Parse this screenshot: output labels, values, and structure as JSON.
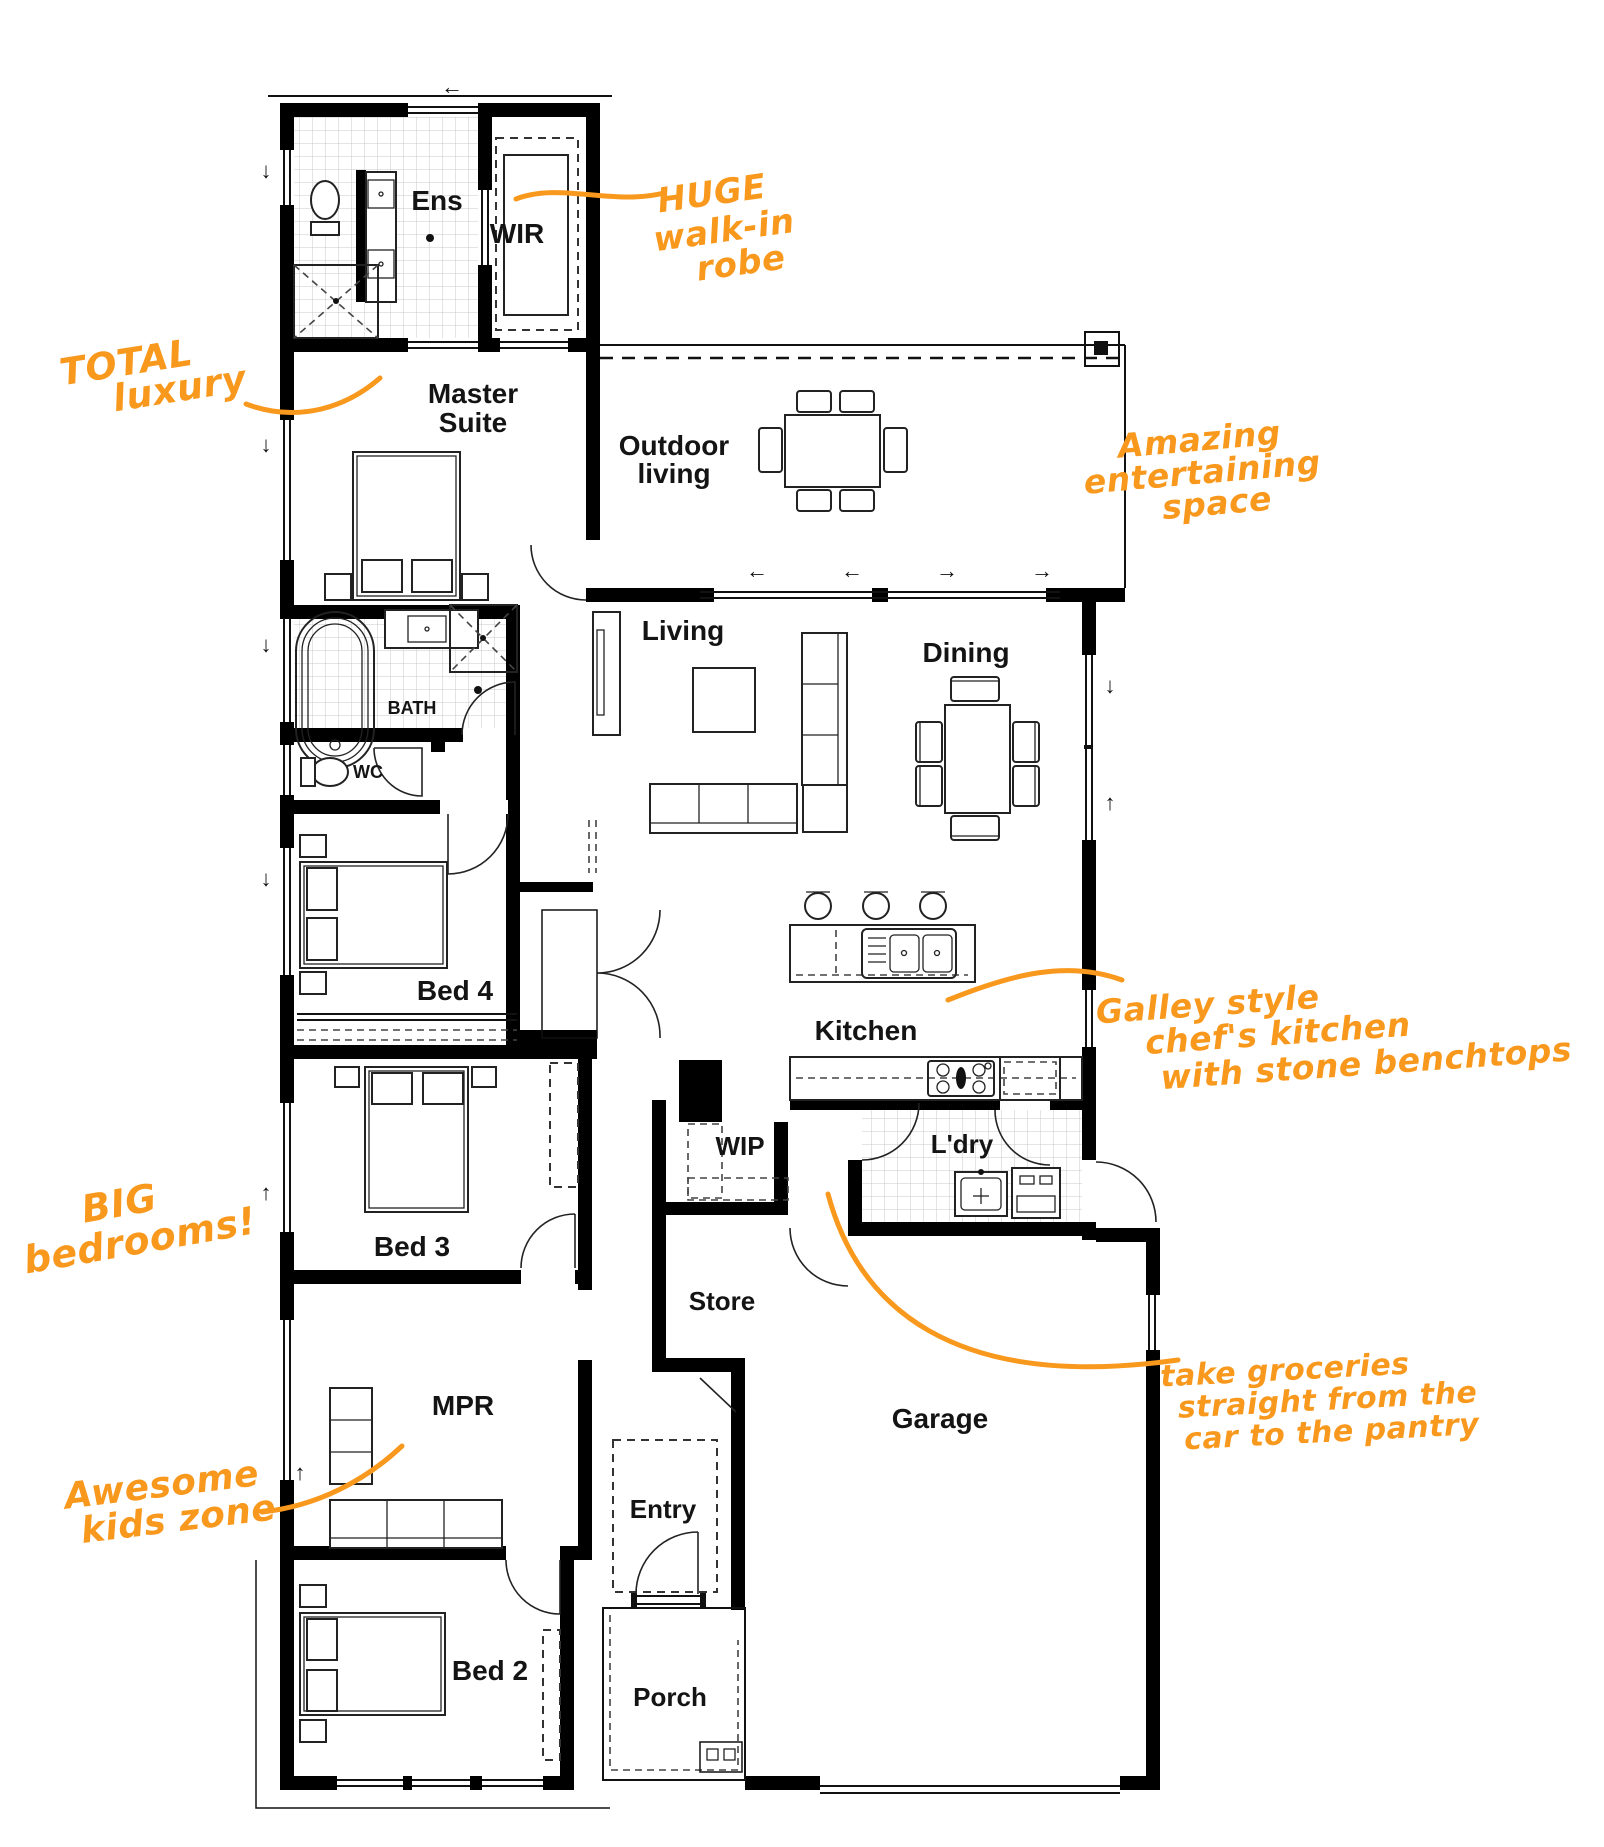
{
  "plan": {
    "colors": {
      "annotation_orange": "#F8981D",
      "wall_black": "#000000",
      "furniture_gray": "#222222",
      "tile_gray": "#c9c9c9"
    },
    "rooms": {
      "ens": {
        "label": "Ens"
      },
      "wir": {
        "label": "WIR"
      },
      "master": {
        "line1": "Master",
        "line2": "Suite"
      },
      "outdoor": {
        "line1": "Outdoor",
        "line2": "living"
      },
      "living": {
        "label": "Living"
      },
      "dining": {
        "label": "Dining"
      },
      "bath": {
        "label": "BATH"
      },
      "wc": {
        "label": "WC"
      },
      "bed4": {
        "label": "Bed 4"
      },
      "kitchen": {
        "label": "Kitchen"
      },
      "wip": {
        "label": "WIP"
      },
      "ldry": {
        "label": "L'dry"
      },
      "bed3": {
        "label": "Bed 3"
      },
      "store": {
        "label": "Store"
      },
      "mpr": {
        "label": "MPR"
      },
      "garage": {
        "label": "Garage"
      },
      "entry": {
        "label": "Entry"
      },
      "bed2": {
        "label": "Bed 2"
      },
      "porch": {
        "label": "Porch"
      }
    },
    "annotations": {
      "huge_robe": {
        "line1": "HUGE",
        "line2": "walk-in",
        "line3": "robe"
      },
      "total_luxury": {
        "line1": "TOTAL",
        "line2": "luxury"
      },
      "amazing": {
        "line1": "Amazing",
        "line2": "entertaining",
        "line3": "space"
      },
      "galley": {
        "line1": "Galley style",
        "line2": "chef's kitchen",
        "line3": "with stone benchtops"
      },
      "big_bedrooms": {
        "line1": "BIG",
        "line2": "bedrooms!"
      },
      "groceries": {
        "line1": "take groceries",
        "line2": "straight from the",
        "line3": "car to the pantry"
      },
      "kids_zone": {
        "line1": "Awesome",
        "line2": "kids zone"
      }
    },
    "arrows": {
      "left": "←",
      "right": "→",
      "up": "↑",
      "down": "↓"
    }
  }
}
